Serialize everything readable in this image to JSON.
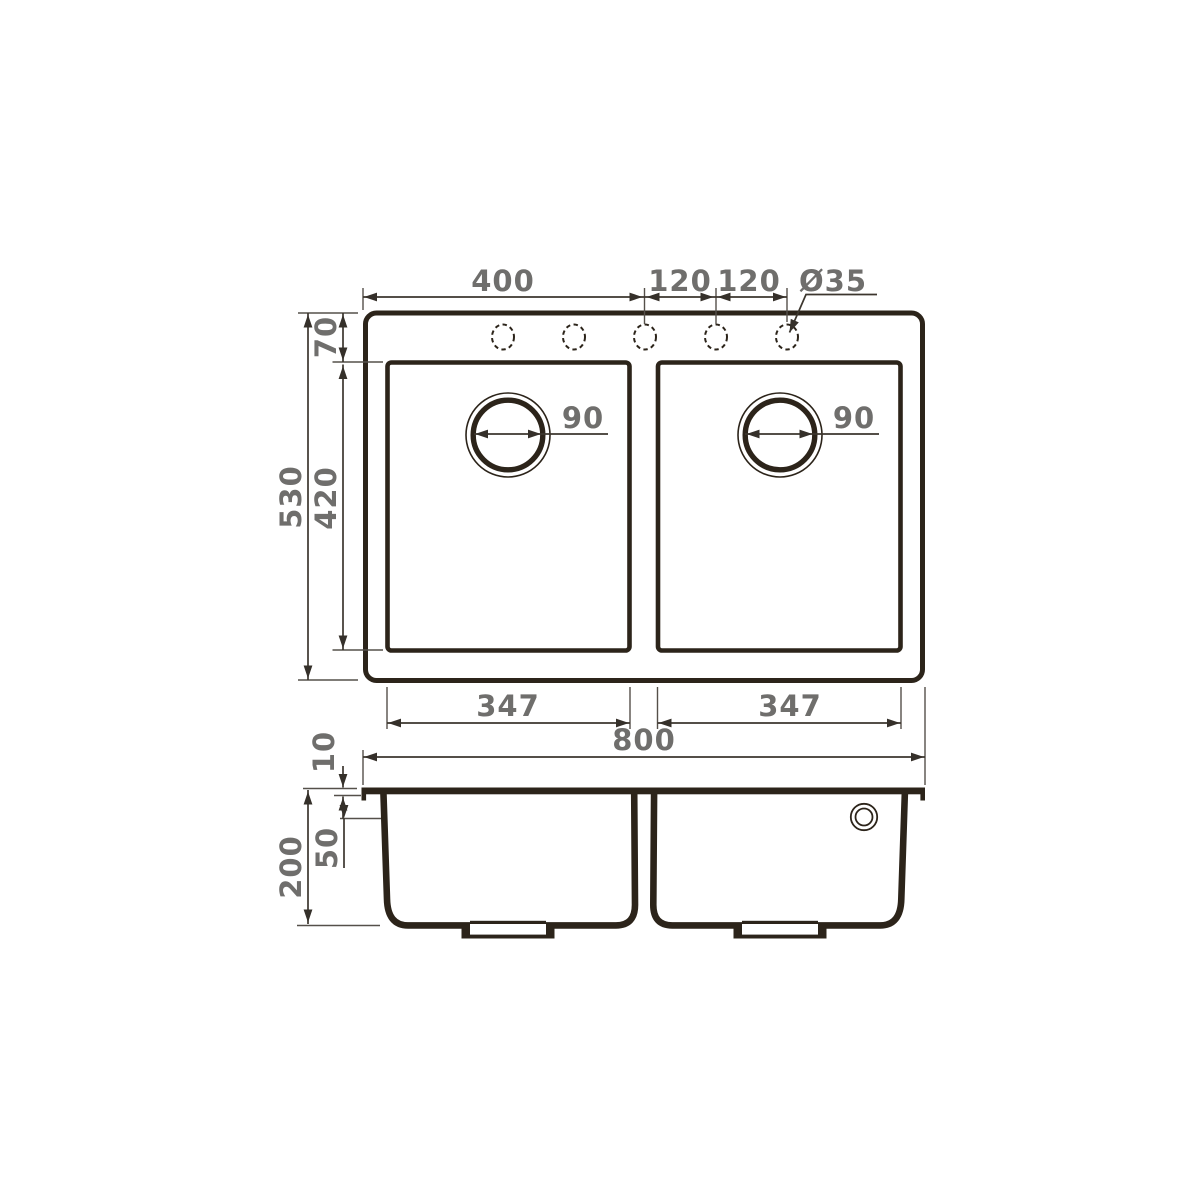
{
  "drawing": {
    "description": "Technical dimension drawing of a double-bowl kitchen sink: top view and cross-section",
    "top_view": {
      "dim_left_edge_to_center_hole": "400",
      "dim_hole_pitch_left": "120",
      "dim_hole_pitch_right": "120",
      "faucet_hole_diameter": "Ø35",
      "dim_overall_depth": "530",
      "dim_rim_to_bowl": "70",
      "dim_bowl_front_to_back": "420",
      "dim_left_drain_diameter": "90",
      "dim_right_drain_diameter": "90",
      "dim_left_bowl_width": "347",
      "dim_right_bowl_width": "347",
      "dim_overall_width": "800"
    },
    "section_view": {
      "dim_rim_thickness": "10",
      "dim_upper_ledge_depth": "50",
      "dim_bowl_depth": "200"
    },
    "colors": {
      "line": "#2c241a",
      "dimension_text": "#6f6e6c"
    }
  }
}
